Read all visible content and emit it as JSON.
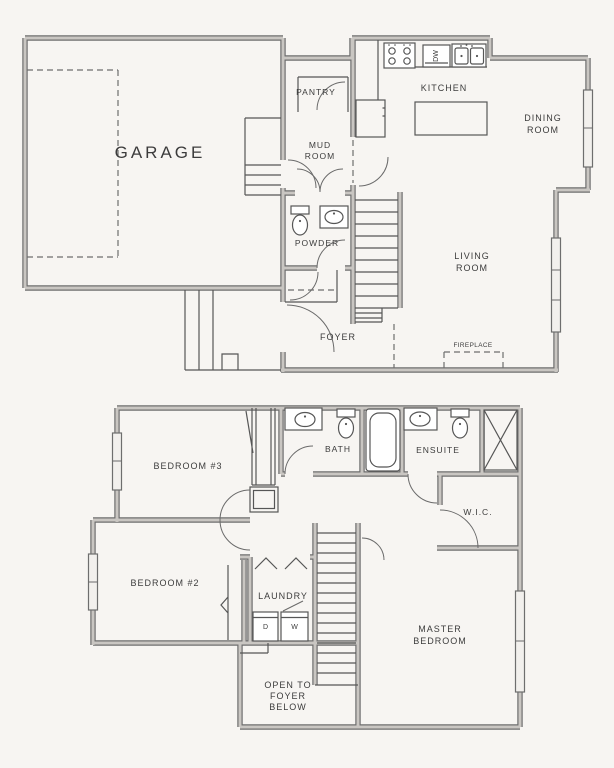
{
  "type": "floor-plan",
  "colors": {
    "background": "#f7f5f2",
    "wall_edge": "#6e6e6e",
    "wall_fill": "#c9c6c2",
    "line": "#565656",
    "text": "#3c3c3c"
  },
  "floor1": {
    "garage": "GARAGE",
    "pantry": "PANTRY",
    "kitchen": "KITCHEN",
    "dining": {
      "line1": "DINING",
      "line2": "ROOM"
    },
    "mud_room": {
      "line1": "MUD",
      "line2": "ROOM"
    },
    "powder": "POWDER",
    "living": {
      "line1": "LIVING",
      "line2": "ROOM"
    },
    "foyer": "FOYER",
    "fireplace": "FIREPLACE",
    "dishwasher": "DW"
  },
  "floor2": {
    "bedroom3": "BEDROOM #3",
    "bath": "BATH",
    "ensuite": "ENSUITE",
    "wic": "W.I.C.",
    "bedroom2": "BEDROOM #2",
    "laundry": "LAUNDRY",
    "master": {
      "line1": "MASTER",
      "line2": "BEDROOM"
    },
    "open_to_foyer": {
      "line1": "OPEN TO",
      "line2": "FOYER",
      "line3": "BELOW"
    },
    "dryer": "D",
    "washer": "W"
  }
}
